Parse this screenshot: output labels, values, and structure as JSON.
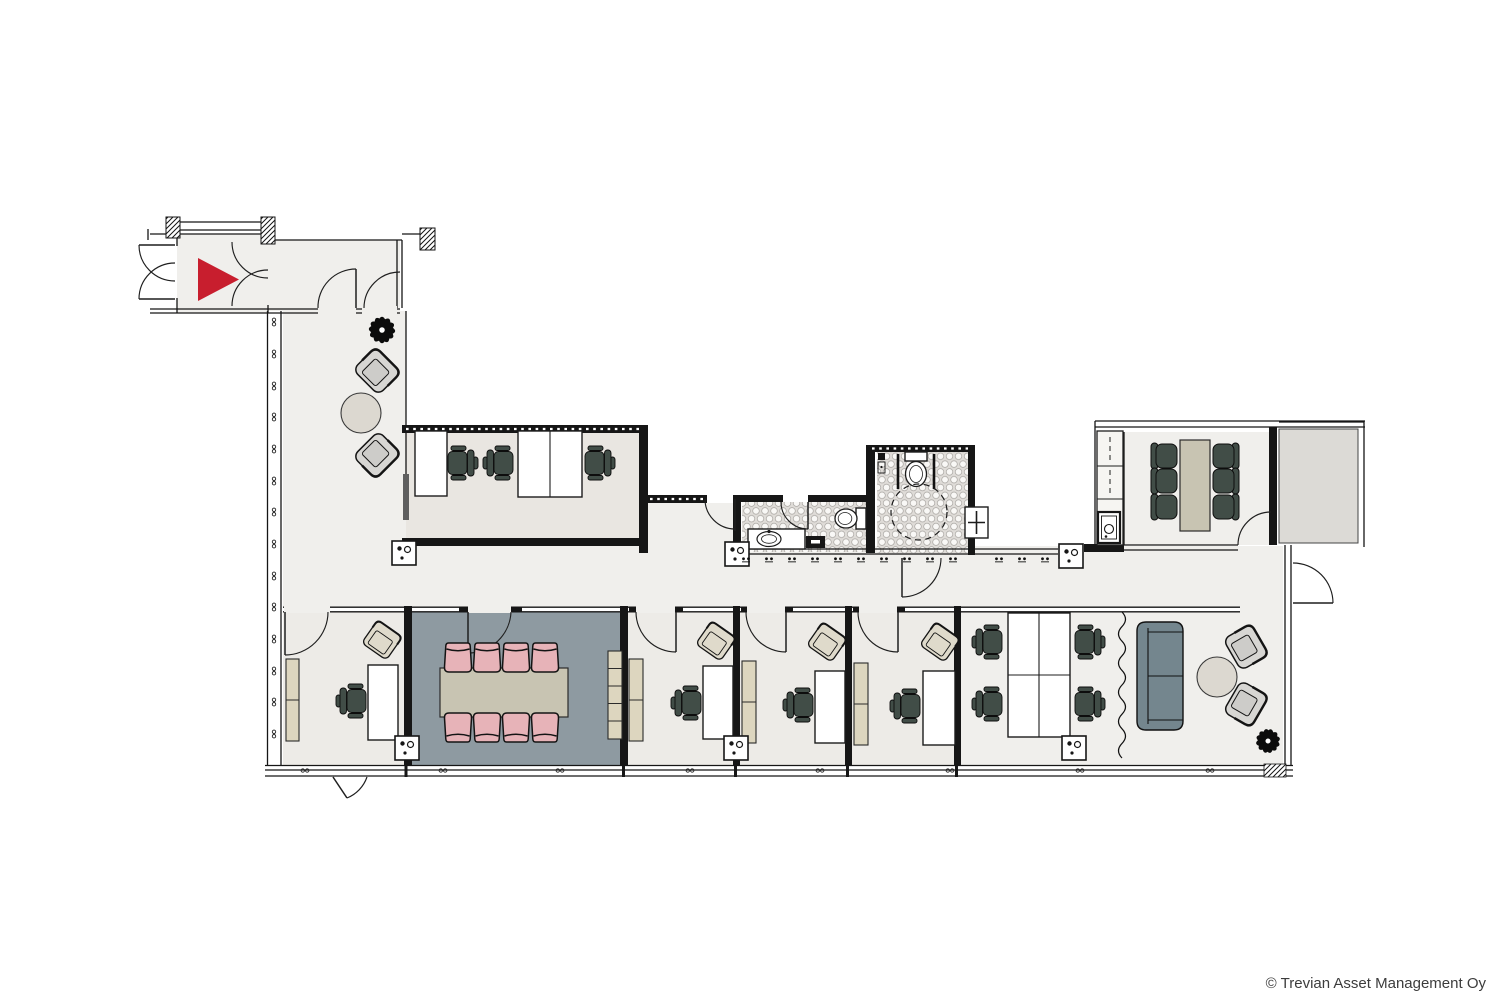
{
  "copyright": "© Trevian Asset Management Oy",
  "colors": {
    "wall": "#161616",
    "floor_main": "#f0efec",
    "floor_office": "#e9e6e1",
    "floor_rooms": "#edebe7",
    "floor_meeting_gray": "#8e9aa1",
    "floor_terrace": "#dcdad6",
    "desk": "#ffffff",
    "chair_dark": "#414d47",
    "chair_pink": "#e7b3b8",
    "chair_beige": "#dfdacb",
    "chair_gray": "#d7d6d3",
    "sofa": "#74868e",
    "table_beige": "#c8c4b2",
    "cabinet": "#ddd6bf",
    "round_table": "#dcd8d0",
    "marker_gray": "#5f5f5f",
    "accent_red": "#c81e2e",
    "text": "#3c3c3c",
    "bg": "#ffffff"
  },
  "icons": {
    "direction_arrow": "red right-pointing triangle",
    "plant": "black rosette plant symbol",
    "outlet": "electrical outlet square with dots",
    "wheelchair_circle": "dashed turning-radius circle"
  }
}
